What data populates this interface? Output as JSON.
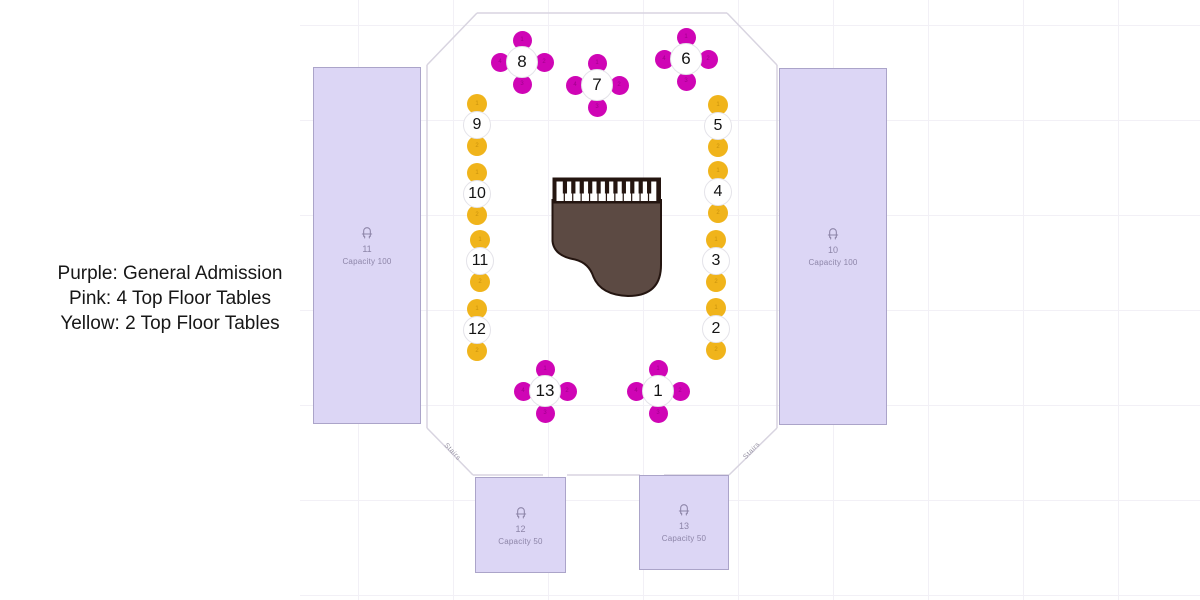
{
  "legend": {
    "lines": [
      "Purple: General Admission",
      "Pink: 4 Top Floor Tables",
      "Yellow: 2 Top Floor Tables"
    ]
  },
  "colors": {
    "pink_seat": "#cf05b5",
    "pink_seat_digit": "#a1018c",
    "yellow_seat": "#f0b41b",
    "yellow_seat_digit": "#c9920c",
    "section_fill": "#dcd6f5",
    "section_border": "#aba4c9",
    "section_text": "#8d85a8",
    "wall": "#d8d4e0",
    "grid": "#f2f0f6",
    "piano_body": "#5c4a43",
    "piano_outline": "#241510",
    "table_circle_fill": "#ffffff",
    "table_circle_border": "#e4e3e9",
    "table_number_color": "#141414"
  },
  "map": {
    "sections": [
      {
        "number": "11",
        "capacity": "Capacity 100",
        "x": 313,
        "y": 67,
        "w": 108,
        "h": 357
      },
      {
        "number": "10",
        "capacity": "Capacity 100",
        "x": 779,
        "y": 68,
        "w": 108,
        "h": 357
      },
      {
        "number": "12",
        "capacity": "Capacity 50",
        "x": 475,
        "y": 477,
        "w": 91,
        "h": 96
      },
      {
        "number": "13",
        "capacity": "Capacity 50",
        "x": 639,
        "y": 475,
        "w": 90,
        "h": 95
      }
    ],
    "tables": [
      {
        "number": "1",
        "type": "4top",
        "x": 658,
        "y": 391
      },
      {
        "number": "2",
        "type": "2top",
        "x": 716,
        "y": 329
      },
      {
        "number": "3",
        "type": "2top",
        "x": 716,
        "y": 261
      },
      {
        "number": "4",
        "type": "2top",
        "x": 718,
        "y": 192
      },
      {
        "number": "5",
        "type": "2top",
        "x": 718,
        "y": 126
      },
      {
        "number": "6",
        "type": "4top",
        "x": 686,
        "y": 59
      },
      {
        "number": "7",
        "type": "4top",
        "x": 597,
        "y": 85
      },
      {
        "number": "8",
        "type": "4top",
        "x": 522,
        "y": 62
      },
      {
        "number": "9",
        "type": "2top",
        "x": 477,
        "y": 125
      },
      {
        "number": "10",
        "type": "2top",
        "x": 477,
        "y": 194
      },
      {
        "number": "11",
        "type": "2top",
        "x": 480,
        "y": 261
      },
      {
        "number": "12",
        "type": "2top",
        "x": 477,
        "y": 330
      },
      {
        "number": "13",
        "type": "4top",
        "x": 545,
        "y": 391
      }
    ],
    "seat_numbers": {
      "two_top": [
        "1",
        "2"
      ],
      "four_top": [
        "1",
        "2",
        "3",
        "4"
      ]
    },
    "stairs": [
      {
        "label": "Stairs",
        "x": 451,
        "y": 453,
        "angle": 47
      },
      {
        "label": "Stairs",
        "x": 753,
        "y": 452,
        "angle": -46
      }
    ],
    "walls": [
      [
        427,
        65,
        477,
        13
      ],
      [
        477,
        13,
        727,
        13
      ],
      [
        727,
        13,
        777,
        65
      ],
      [
        777,
        65,
        777,
        428
      ],
      [
        777,
        428,
        729,
        475
      ],
      [
        729,
        475,
        664,
        475
      ],
      [
        640,
        475,
        567,
        475
      ],
      [
        543,
        475,
        473,
        475
      ],
      [
        473,
        475,
        427,
        428
      ],
      [
        427,
        428,
        427,
        65
      ]
    ]
  }
}
